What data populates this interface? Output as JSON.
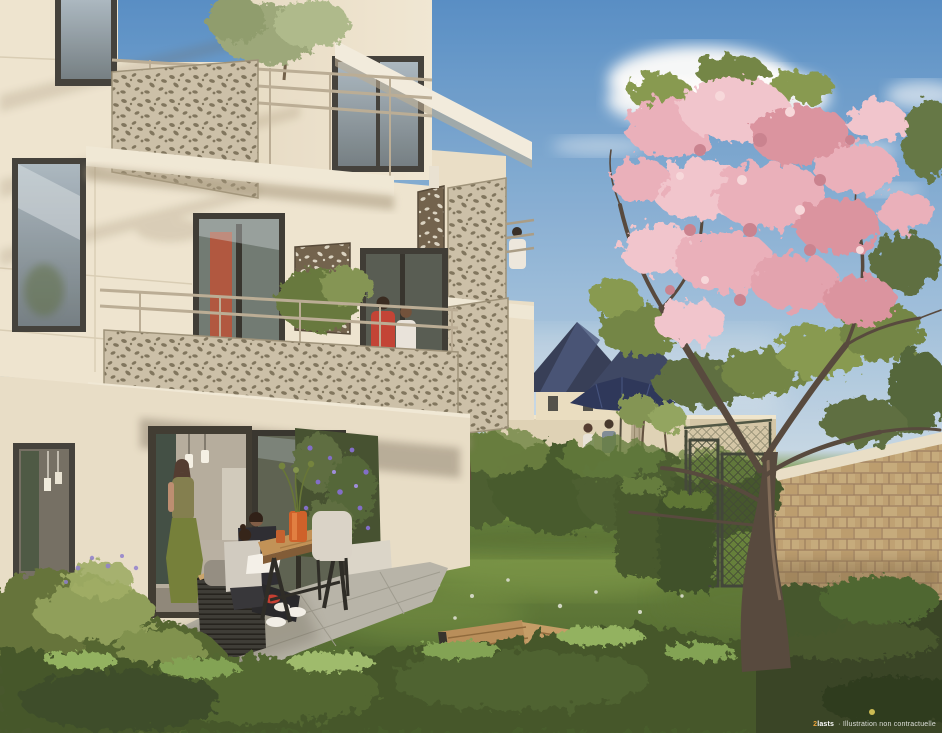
{
  "watermark": {
    "logo": "2lasts",
    "text": "· Illustration non contractuelle"
  },
  "palette": {
    "sky_top": "#4f8ac6",
    "sky_horizon": "#d7e3ec",
    "facade_cream": "#ede5d2",
    "facade_shade": "#e2d7bf",
    "panel_champagne": "#c9bfa8",
    "screen_bronze": "#6b5c48",
    "lawn_green": "#5f7e36",
    "hedge_green": "#42582c",
    "blossom_pink": "#e9aebc",
    "roof_slate_blue": "#2c3652",
    "parasol_navy": "#232e55",
    "brick_beige": "#c3a87a",
    "table_wood": "#bf8e52",
    "red_shirt": "#c03b2f",
    "vase_orange": "#cd5a22",
    "purple_bloom": "#7b68c9"
  }
}
